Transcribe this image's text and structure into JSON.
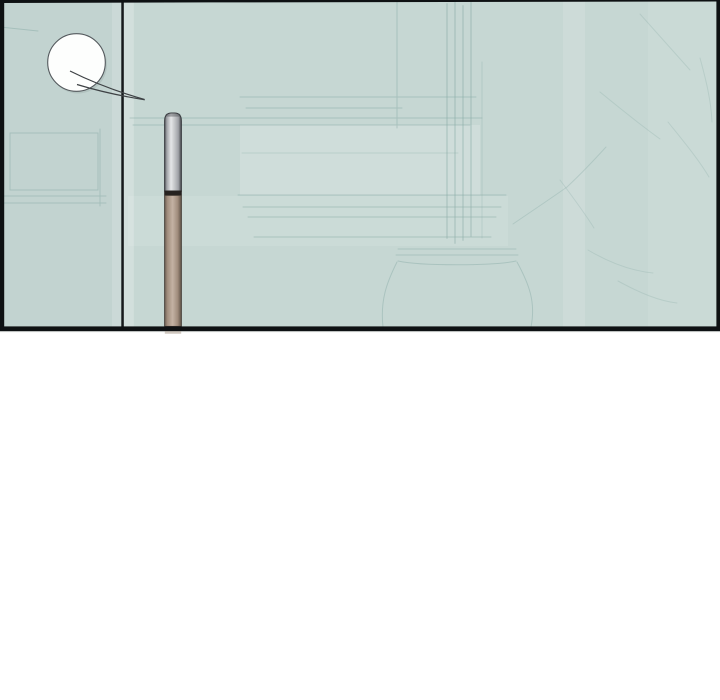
{
  "scene": {
    "kind": "comic-panel",
    "panel_count": 1,
    "speech_bubble": {
      "text": "",
      "shape": "circle",
      "state": "empty"
    }
  },
  "objects": {
    "speech_bubble": "empty-round-speech-bubble",
    "divider": "wall-corner-divider-line",
    "pole": "metal-top-wooden-pole",
    "background": "faint-kitchen-shelves-vase-and-plants",
    "gutter": "white-page-gutter"
  },
  "palette": {
    "page_bg": "#ffffff",
    "panel_bg": "#c6d7d3",
    "panel_bg_left": "#c2d3d0",
    "border": "#0e1113",
    "divider": "#16191b",
    "art_line": "#8aaca7",
    "bubble_fill": "#fdfefd",
    "bubble_stroke": "#54595d",
    "bubble_shadow": "rgba(150,165,162,0.35)",
    "tail": "#3e4245",
    "pole_band": "#262220",
    "silver": {
      "edge": "#54565b",
      "mid": "#a0a2a7",
      "light": "#e5e6e8",
      "mid2": "#caccce",
      "dark": "#45484c",
      "outline": "#3a3d41"
    },
    "tan": {
      "edge": "#6a5d52",
      "mid": "#a08c7c",
      "light": "#c4b2a4",
      "dark": "#5d5146",
      "outline": "#453e37"
    }
  }
}
